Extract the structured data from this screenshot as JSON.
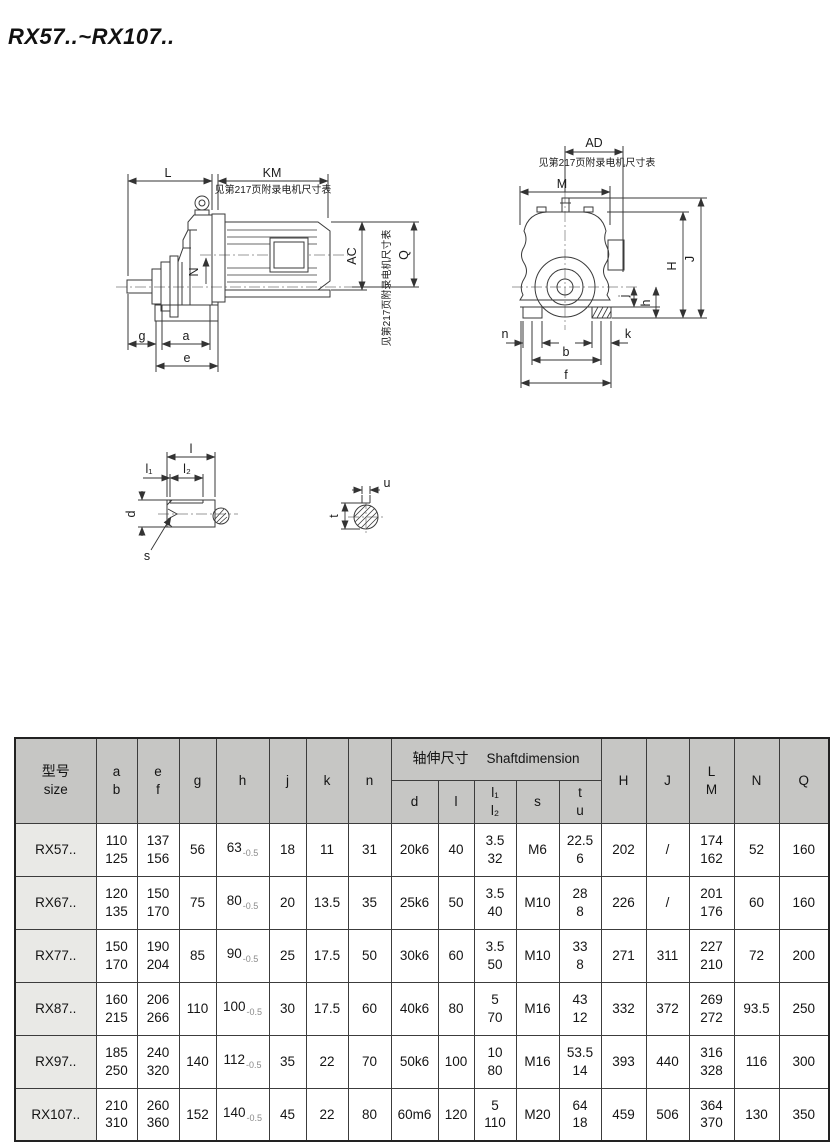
{
  "title": "RX57..~RX107..",
  "drawings": {
    "note": "见第217页附录电机尺寸表",
    "side": {
      "L": "L",
      "KM": "KM",
      "N": "N",
      "AC": "AC",
      "Q": "Q",
      "g": "g",
      "a": "a",
      "e": "e"
    },
    "front": {
      "AD": "AD",
      "M": "M",
      "H": "H",
      "J": "J",
      "j": "j",
      "h": "h",
      "n": "n",
      "k": "k",
      "b": "b",
      "f": "f"
    },
    "shaft": {
      "l": "l",
      "l1": "l₁",
      "l2": "l₂",
      "d": "d",
      "s": "s"
    },
    "section": {
      "u": "u",
      "t": "t"
    }
  },
  "table": {
    "headers": {
      "size": [
        "型号",
        "size"
      ],
      "ab": [
        "a",
        "b"
      ],
      "ef": [
        "e",
        "f"
      ],
      "g": "g",
      "h": "h",
      "j": "j",
      "k": "k",
      "n": "n",
      "shaft_zh": "轴伸尺寸",
      "shaft_en": "Shaftdimension",
      "d": "d",
      "l": "l",
      "l12": [
        "l₁",
        "l₂"
      ],
      "s": "s",
      "tu": [
        "t",
        "u"
      ],
      "H": "H",
      "J": "J",
      "LM": [
        "L",
        "M"
      ],
      "N": "N",
      "Q": "Q"
    },
    "rows": [
      {
        "size": "RX57..",
        "ab": [
          "110",
          "125"
        ],
        "ef": [
          "137",
          "156"
        ],
        "g": "56",
        "h": {
          "v": "63",
          "tol": "-0.5"
        },
        "j": "18",
        "k": "11",
        "n": "31",
        "d": "20k6",
        "l": "40",
        "l12": [
          "3.5",
          "32"
        ],
        "s": "M6",
        "tu": [
          "22.5",
          "6"
        ],
        "H": "202",
        "J": "/",
        "LM": [
          "174",
          "162"
        ],
        "N": "52",
        "Q": "160"
      },
      {
        "size": "RX67..",
        "ab": [
          "120",
          "135"
        ],
        "ef": [
          "150",
          "170"
        ],
        "g": "75",
        "h": {
          "v": "80",
          "tol": "-0.5"
        },
        "j": "20",
        "k": "13.5",
        "n": "35",
        "d": "25k6",
        "l": "50",
        "l12": [
          "3.5",
          "40"
        ],
        "s": "M10",
        "tu": [
          "28",
          "8"
        ],
        "H": "226",
        "J": "/",
        "LM": [
          "201",
          "176"
        ],
        "N": "60",
        "Q": "160"
      },
      {
        "size": "RX77..",
        "ab": [
          "150",
          "170"
        ],
        "ef": [
          "190",
          "204"
        ],
        "g": "85",
        "h": {
          "v": "90",
          "tol": "-0.5"
        },
        "j": "25",
        "k": "17.5",
        "n": "50",
        "d": "30k6",
        "l": "60",
        "l12": [
          "3.5",
          "50"
        ],
        "s": "M10",
        "tu": [
          "33",
          "8"
        ],
        "H": "271",
        "J": "311",
        "LM": [
          "227",
          "210"
        ],
        "N": "72",
        "Q": "200"
      },
      {
        "size": "RX87..",
        "ab": [
          "160",
          "215"
        ],
        "ef": [
          "206",
          "266"
        ],
        "g": "110",
        "h": {
          "v": "100",
          "tol": "-0.5"
        },
        "j": "30",
        "k": "17.5",
        "n": "60",
        "d": "40k6",
        "l": "80",
        "l12": [
          "5",
          "70"
        ],
        "s": "M16",
        "tu": [
          "43",
          "12"
        ],
        "H": "332",
        "J": "372",
        "LM": [
          "269",
          "272"
        ],
        "N": "93.5",
        "Q": "250"
      },
      {
        "size": "RX97..",
        "ab": [
          "185",
          "250"
        ],
        "ef": [
          "240",
          "320"
        ],
        "g": "140",
        "h": {
          "v": "112",
          "tol": "-0.5"
        },
        "j": "35",
        "k": "22",
        "n": "70",
        "d": "50k6",
        "l": "100",
        "l12": [
          "10",
          "80"
        ],
        "s": "M16",
        "tu": [
          "53.5",
          "14"
        ],
        "H": "393",
        "J": "440",
        "LM": [
          "316",
          "328"
        ],
        "N": "116",
        "Q": "300"
      },
      {
        "size": "RX107..",
        "ab": [
          "210",
          "310"
        ],
        "ef": [
          "260",
          "360"
        ],
        "g": "152",
        "h": {
          "v": "140",
          "tol": "-0.5"
        },
        "j": "45",
        "k": "22",
        "n": "80",
        "d": "60m6",
        "l": "120",
        "l12": [
          "5",
          "110"
        ],
        "s": "M20",
        "tu": [
          "64",
          "18"
        ],
        "H": "459",
        "J": "506",
        "LM": [
          "364",
          "370"
        ],
        "N": "130",
        "Q": "350"
      }
    ]
  },
  "colors": {
    "header_bg": "#c6c6c4",
    "size_col_bg": "#e9e9e6",
    "border": "#3c3c3c",
    "line": "#3a3a3a"
  }
}
